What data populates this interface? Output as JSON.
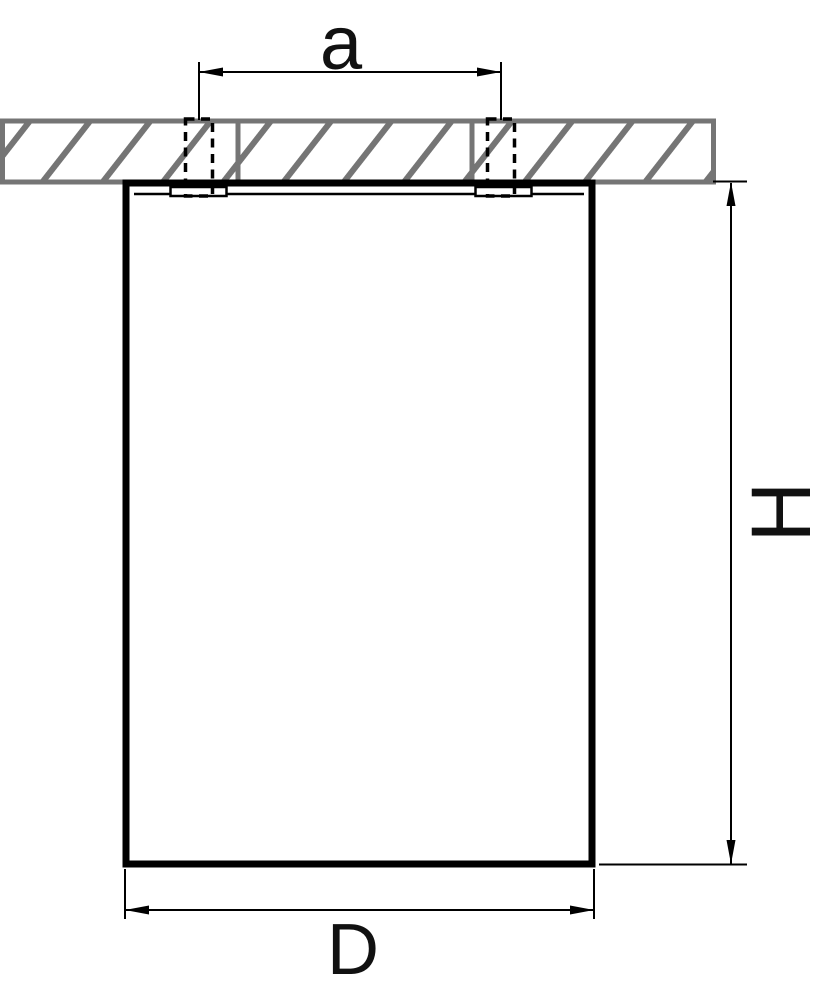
{
  "diagram": {
    "kind": "technical-dimension-drawing",
    "subject": "surface-mounted ceiling cylinder fixture, side section view",
    "labels": {
      "mount_spacing": "a",
      "height": "H",
      "diameter": "D"
    },
    "colors": {
      "line": "#000000",
      "hatch_gray": "#757575",
      "background": "#ffffff",
      "label": "#111111"
    }
  }
}
